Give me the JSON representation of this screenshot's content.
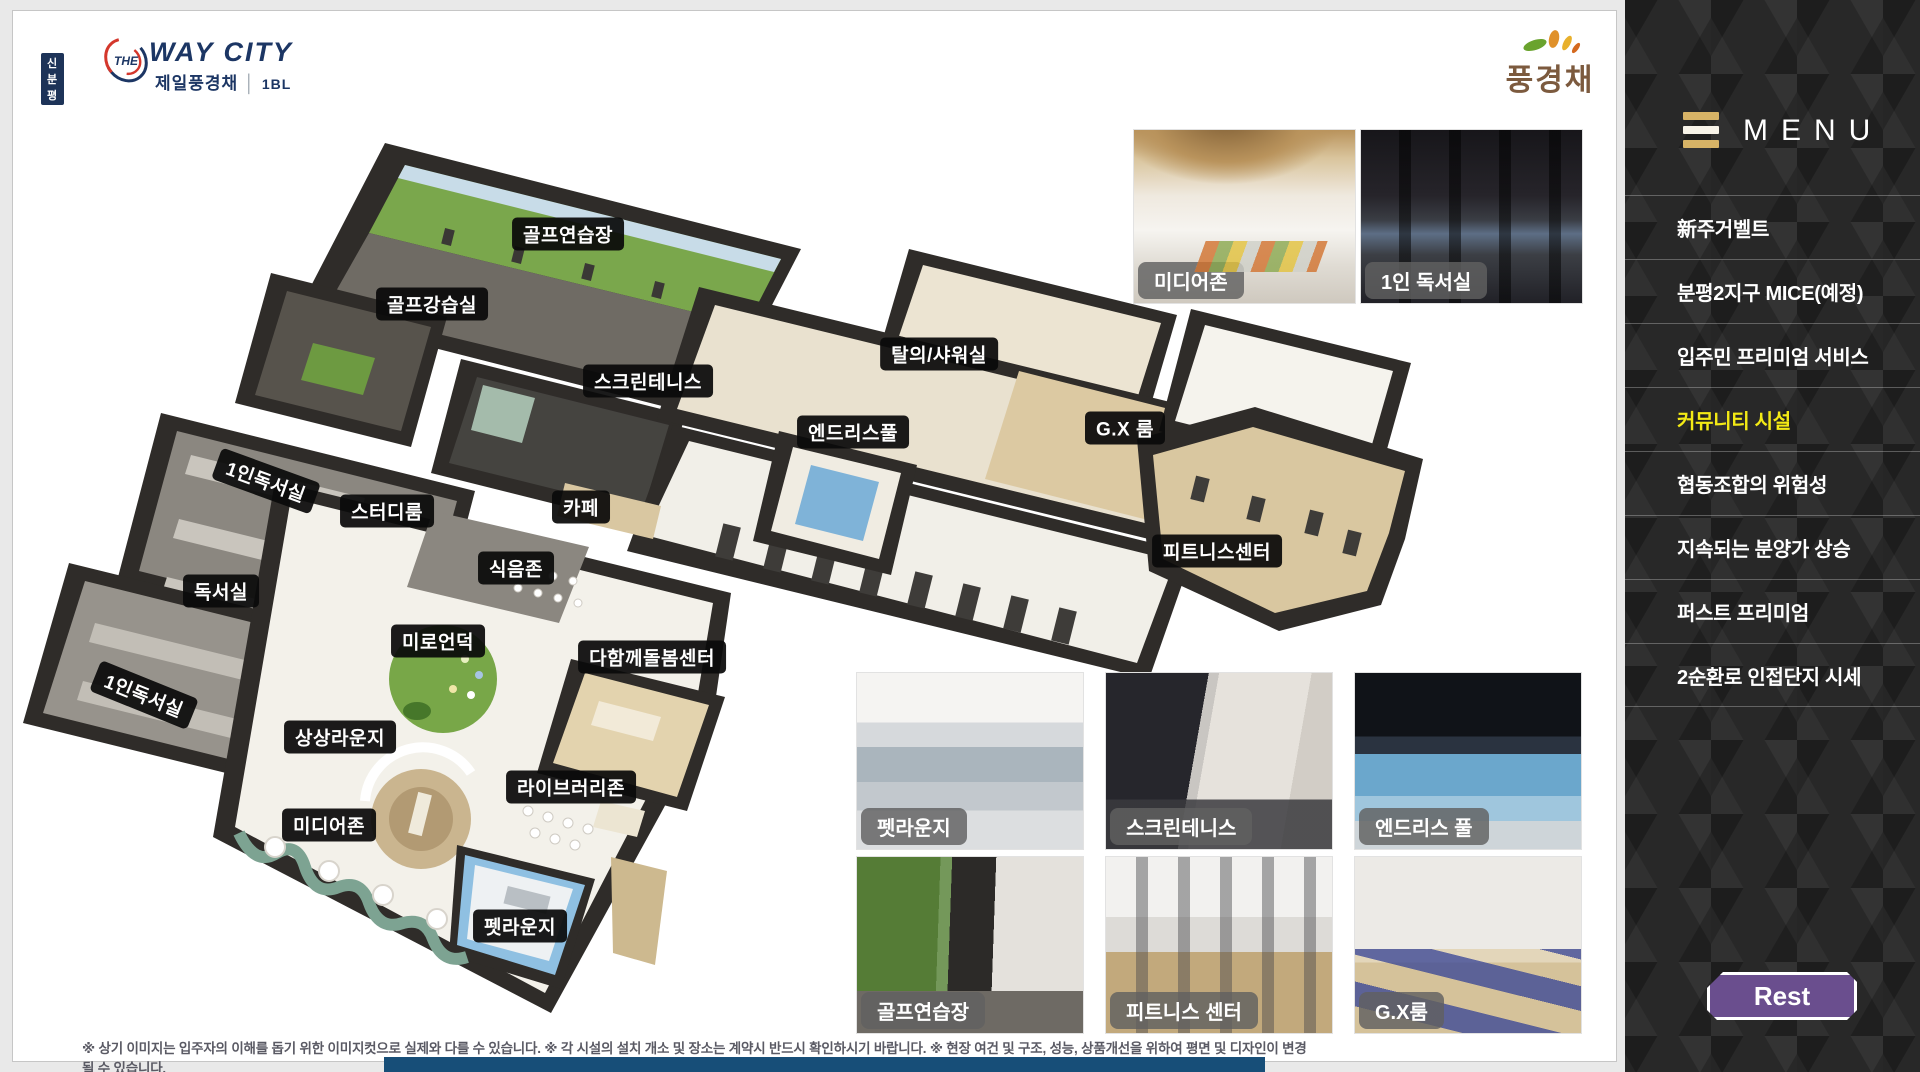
{
  "header": {
    "badge": "신분평",
    "brand_the": "THE",
    "brand_name": "WAY CITY",
    "sub_brand": "제일풍경채",
    "block_no": "1BL",
    "logo_right": "풍경채"
  },
  "floorplan": {
    "labels": [
      {
        "text": "골프연습장",
        "x": 555,
        "y": 223,
        "rot": 0
      },
      {
        "text": "골프강습실",
        "x": 419,
        "y": 293,
        "rot": 0
      },
      {
        "text": "스크린테니스",
        "x": 635,
        "y": 370,
        "rot": 0
      },
      {
        "text": "탈의/샤워실",
        "x": 926,
        "y": 343,
        "rot": 0
      },
      {
        "text": "엔드리스풀",
        "x": 840,
        "y": 421,
        "rot": 0
      },
      {
        "text": "G.X 룸",
        "x": 1112,
        "y": 417,
        "rot": 0
      },
      {
        "text": "피트니스센터",
        "x": 1204,
        "y": 540,
        "rot": 0
      },
      {
        "text": "1인독서실",
        "x": 253,
        "y": 470,
        "rot": 20
      },
      {
        "text": "스터디룸",
        "x": 374,
        "y": 500,
        "rot": 0
      },
      {
        "text": "카페",
        "x": 568,
        "y": 496,
        "rot": 0
      },
      {
        "text": "식음존",
        "x": 503,
        "y": 557,
        "rot": 0
      },
      {
        "text": "독서실",
        "x": 208,
        "y": 580,
        "rot": 0
      },
      {
        "text": "미로언덕",
        "x": 425,
        "y": 630,
        "rot": 0
      },
      {
        "text": "다함께돌봄센터",
        "x": 639,
        "y": 646,
        "rot": 0
      },
      {
        "text": "1인독서실",
        "x": 131,
        "y": 684,
        "rot": 22
      },
      {
        "text": "상상라운지",
        "x": 327,
        "y": 726,
        "rot": 0
      },
      {
        "text": "라이브러리존",
        "x": 558,
        "y": 776,
        "rot": 0
      },
      {
        "text": "미디어존",
        "x": 316,
        "y": 814,
        "rot": 0
      },
      {
        "text": "펫라운지",
        "x": 507,
        "y": 915,
        "rot": 0
      }
    ]
  },
  "gallery_top": [
    {
      "caption": "미디어존",
      "variant": "photo-media-zone"
    },
    {
      "caption": "1인 독서실",
      "variant": "photo-study-room"
    }
  ],
  "gallery_bottom": [
    {
      "caption": "펫라운지",
      "variant": "photo-pet-lounge"
    },
    {
      "caption": "스크린테니스",
      "variant": "photo-screen-tennis"
    },
    {
      "caption": "엔드리스 풀",
      "variant": "photo-endless-pool"
    },
    {
      "caption": "골프연습장",
      "variant": "photo-golf-range"
    },
    {
      "caption": "피트니스 센터",
      "variant": "photo-fitness-center"
    },
    {
      "caption": "G.X룸",
      "variant": "photo-gx-room"
    }
  ],
  "menu": {
    "title": "MENU",
    "items": [
      {
        "label": "新주거벨트",
        "active": false
      },
      {
        "label": "분평2지구 MICE(예정)",
        "active": false
      },
      {
        "label": "입주민 프리미엄 서비스",
        "active": false
      },
      {
        "label": "커뮤니티 시설",
        "active": true
      },
      {
        "label": "협동조합의 위험성",
        "active": false
      },
      {
        "label": "지속되는 분양가 상승",
        "active": false
      },
      {
        "label": "퍼스트 프리미엄",
        "active": false
      },
      {
        "label": "2순환로 인접단지 시세",
        "active": false
      }
    ],
    "rest_label": "Rest"
  },
  "disclaimer": "※ 상기 이미지는 입주자의 이해를 돕기 위한 이미지컷으로 실제와 다를 수 있습니다. ※ 각 시설의 설치 개소 및 장소는 계약시 반드시 확인하시기 바랍니다. ※ 현장 여건 및 구조, 성능, 상품개선을 위하여 평면 및 디자인이 변경될 수 있습니다.",
  "colors": {
    "menu_active": "#f3ea15",
    "rest_button": "#6a4e8e",
    "brand_navy": "#1c3664",
    "logo_brown": "#7c5a3e",
    "footer_bar": "#174e78",
    "sidebar_bg": "#282828",
    "hamburger_gold": "#d7b366"
  }
}
